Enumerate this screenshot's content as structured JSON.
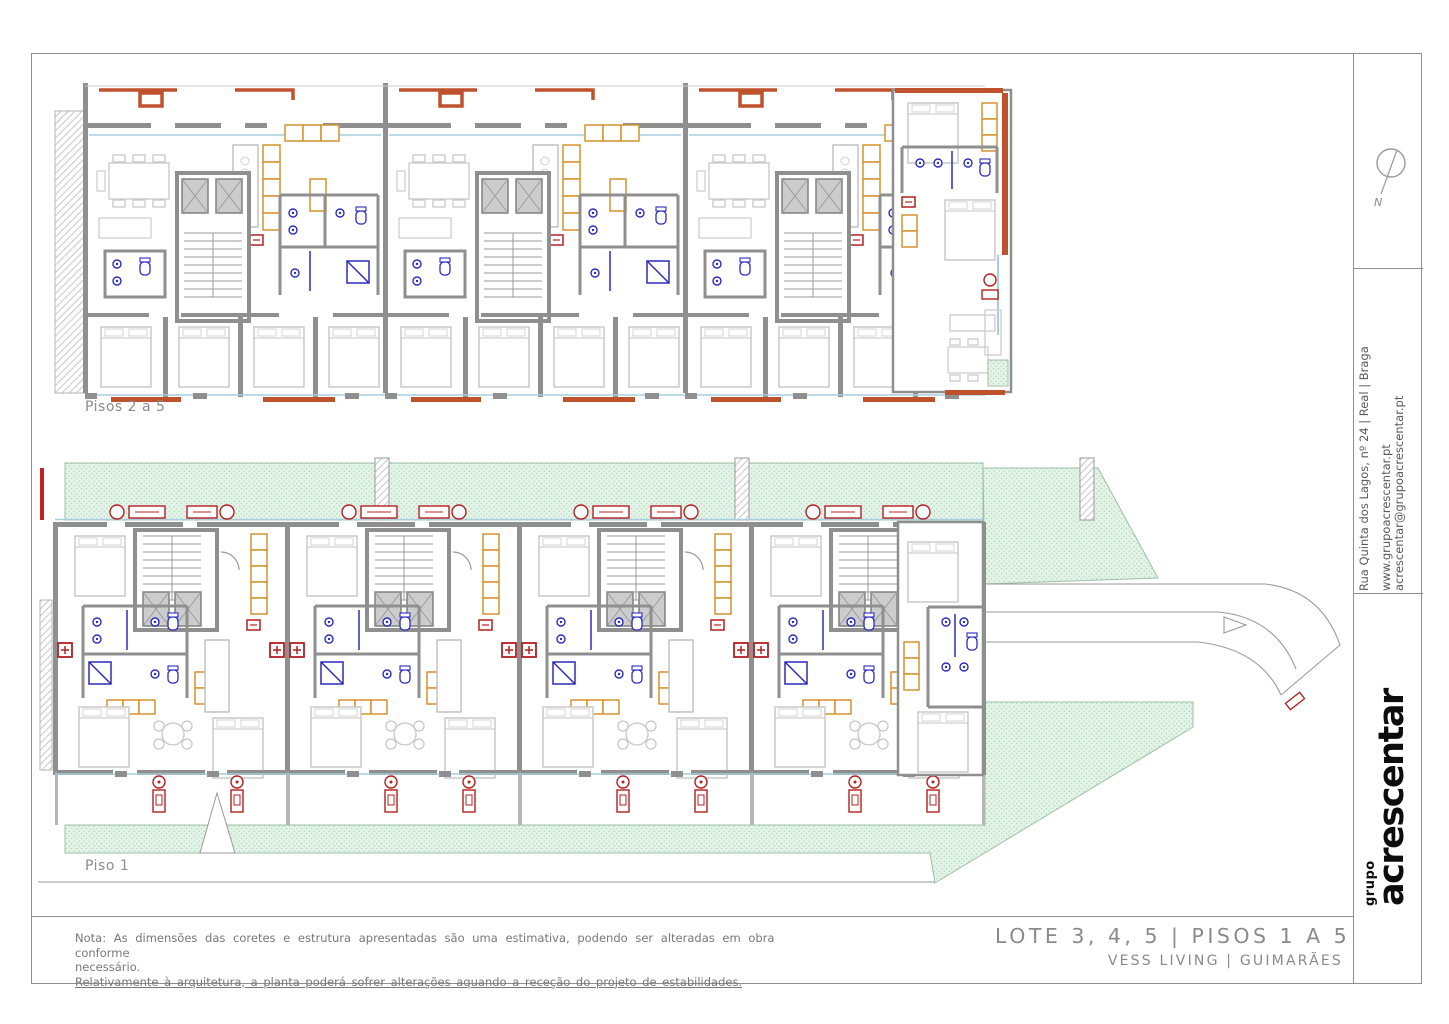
{
  "sheet": {
    "plan_labels": {
      "upper": "Pisos 2 a 5",
      "lower": "Piso 1"
    },
    "notes": {
      "line1": "Nota: As dimensões das coretes e estrutura apresentadas são uma estimativa, podendo ser alteradas em obra conforme",
      "line2": "necessário.",
      "line3": "Relativamente à arquitetura, a planta poderá sofrer alterações aquando a receção do projeto de estabilidades."
    },
    "title_block": {
      "title": "LOTE 3, 4, 5 | PISOS 1 A 5",
      "subtitle": "VESS LIVING | GUIMARÃES"
    },
    "company": {
      "logo_small": "grupo",
      "logo_main": "acrescentar",
      "address": "Rua Quinta dos Lagos, nº 24 | Real | Braga",
      "website": "www.grupoacrescentar.pt",
      "email": "acrescentar@grupoacrescentar.pt"
    },
    "compass": {
      "label": "N"
    },
    "colors": {
      "wall_gray": "#8f8f8f",
      "cabinet_orange": "#d6922f",
      "fixture_blue": "#2b2bbf",
      "accent_red": "#b32020",
      "terrace_red": "#bf512d",
      "glazing_blue": "#a9cede",
      "landscape_green": "#e4f3e8",
      "frame_gray": "#8f8f8f"
    }
  }
}
